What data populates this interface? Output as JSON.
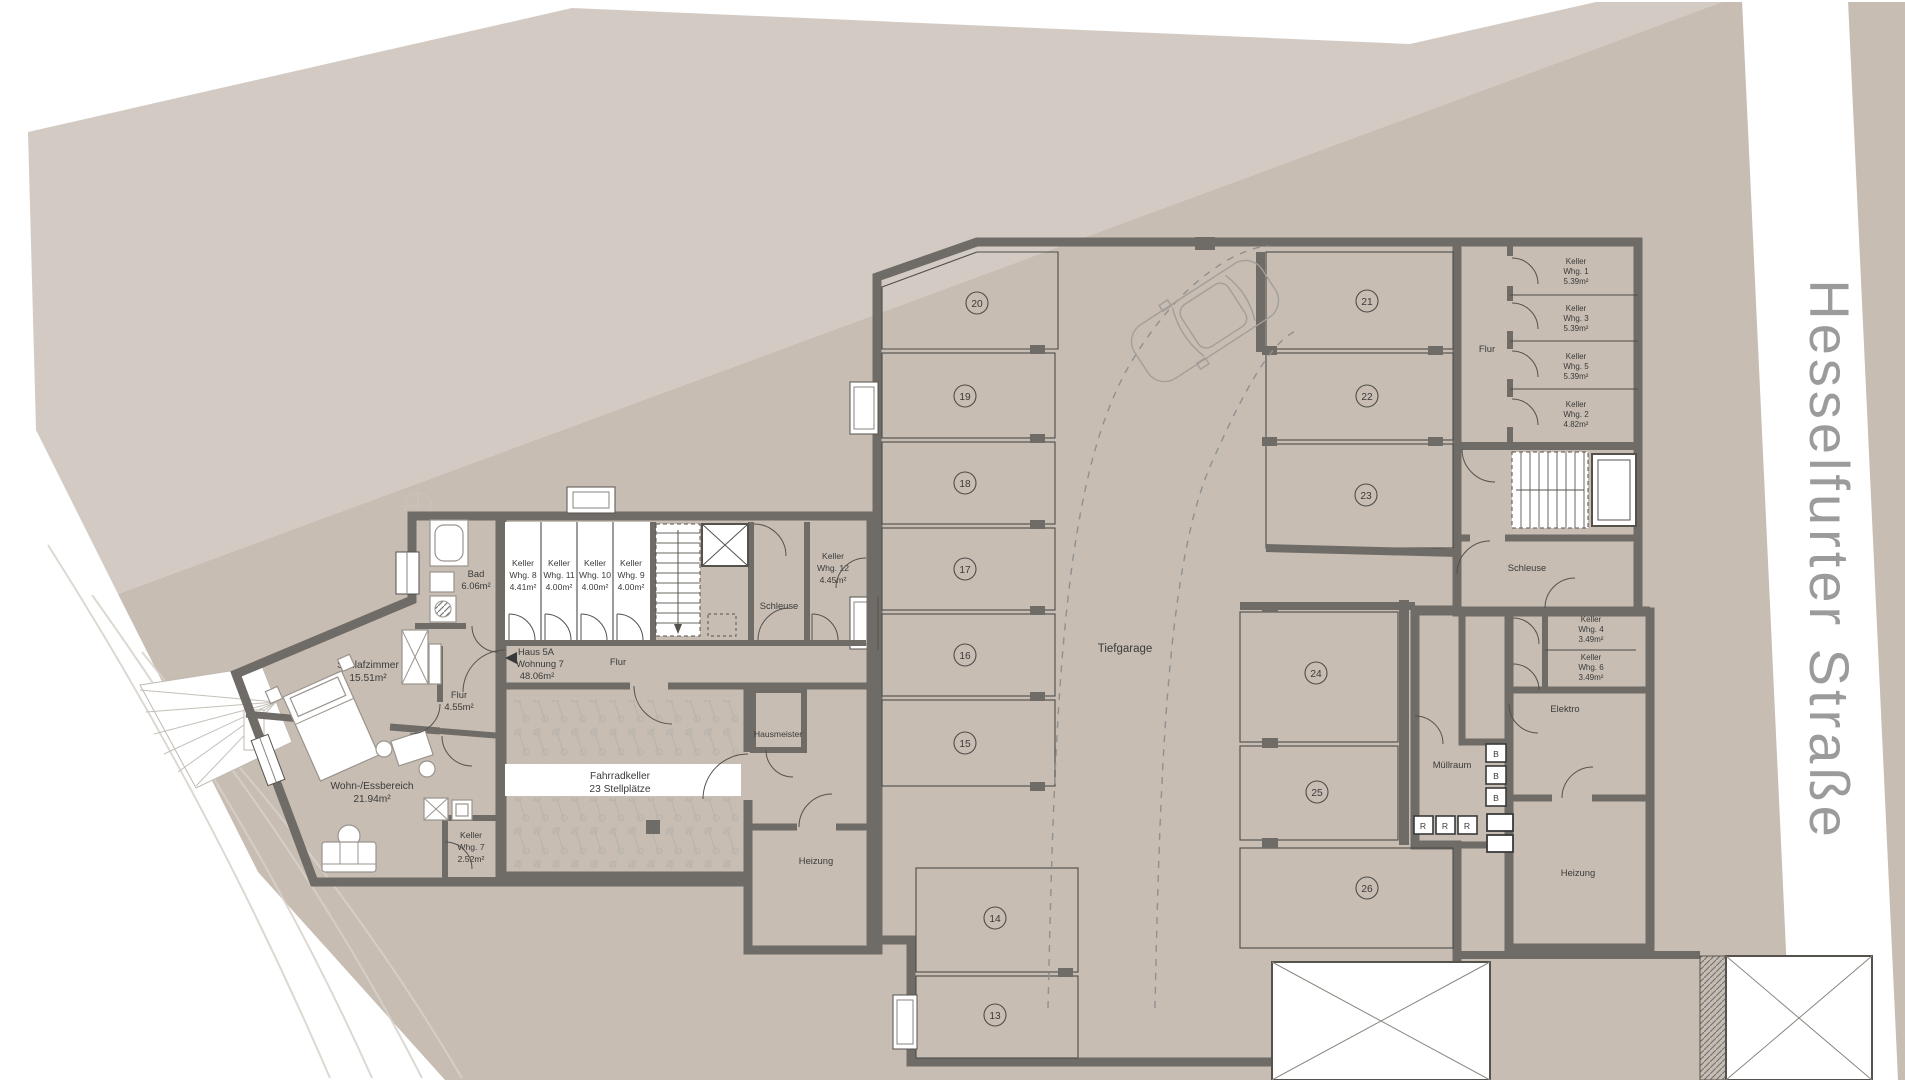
{
  "street": {
    "name": "Hesselfurter Straße"
  },
  "building": {
    "apartment": {
      "haus": "Haus 5A",
      "wohnung": "Wohnung 7",
      "area": "48.06m²",
      "schlafzimmer": {
        "l1": "Schlafzimmer",
        "l2": "15.51m²"
      },
      "wohnbereich": {
        "l1": "Wohn-/Essbereich",
        "l2": "21.94m²"
      },
      "flur": {
        "l1": "Flur",
        "l2": "4.55m²"
      },
      "bad": {
        "l1": "Bad",
        "l2": "6.06m²"
      },
      "keller7": {
        "l1": "Keller",
        "l2": "Whg. 7",
        "l3": "2.52m²"
      }
    },
    "cellars_top": [
      {
        "l1": "Keller",
        "l2": "Whg. 8",
        "l3": "4.41m²"
      },
      {
        "l1": "Keller",
        "l2": "Whg. 11",
        "l3": "4.00m²"
      },
      {
        "l1": "Keller",
        "l2": "Whg. 10",
        "l3": "4.00m²"
      },
      {
        "l1": "Keller",
        "l2": "Whg. 9",
        "l3": "4.00m²"
      }
    ],
    "keller12": {
      "l1": "Keller",
      "l2": "Whg. 12",
      "l3": "4.45m²"
    },
    "corridor_flur": "Flur",
    "schleuse_left": "Schleuse",
    "hausmeister": "Hausmeister",
    "heizung_left": "Heizung",
    "fahrradkeller": {
      "l1": "Fahrradkeller",
      "l2": "23 Stellplätze"
    },
    "right_wing": {
      "flur": "Flur",
      "cellars": [
        {
          "l1": "Keller",
          "l2": "Whg. 1",
          "l3": "5.39m²"
        },
        {
          "l1": "Keller",
          "l2": "Whg. 3",
          "l3": "5.39m²"
        },
        {
          "l1": "Keller",
          "l2": "Whg. 5",
          "l3": "5.39m²"
        },
        {
          "l1": "Keller",
          "l2": "Whg. 2",
          "l3": "4.82m²"
        }
      ],
      "schleuse": "Schleuse",
      "keller4": {
        "l1": "Keller",
        "l2": "Whg. 4",
        "l3": "3.49m²"
      },
      "keller6": {
        "l1": "Keller",
        "l2": "Whg. 6",
        "l3": "3.49m²"
      },
      "elektro": "Elektro",
      "muellraum": "Müllraum",
      "heizung": "Heizung",
      "bins": {
        "b": "B",
        "r": "R"
      }
    },
    "garage": {
      "title": "Tiefgarage",
      "stalls": [
        "13",
        "14",
        "15",
        "16",
        "17",
        "18",
        "19",
        "20",
        "21",
        "22",
        "23",
        "24",
        "25",
        "26"
      ]
    }
  },
  "colors": {
    "site": "#c7bdb3",
    "site_light": "#d3cbc3",
    "wall": "#6f6b66",
    "floor_apartment": "#e9e1da",
    "stall": "#edeae5",
    "street_text": "#9b9b9b"
  }
}
